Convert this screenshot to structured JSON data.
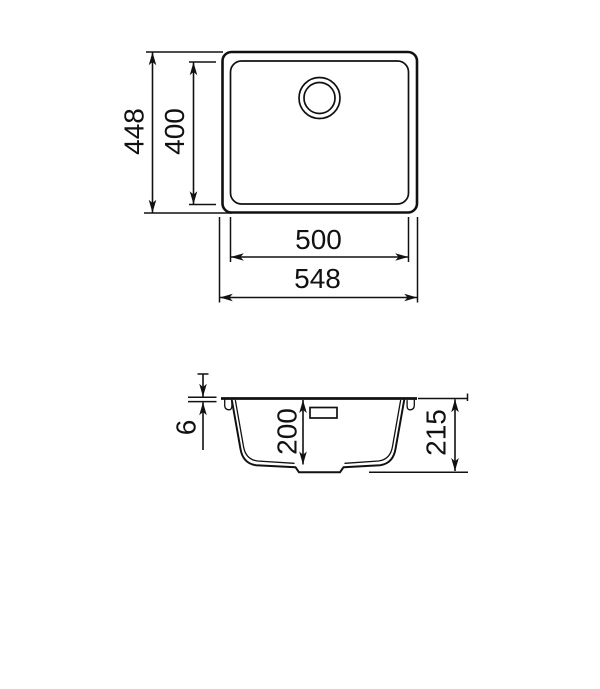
{
  "drawing": {
    "kind": "sink-dimension-drawing",
    "colors": {
      "line": "#111111",
      "background": "#ffffff"
    },
    "top_view": {
      "dim_outer_height": "448",
      "dim_inner_height": "400",
      "dim_inner_width": "500",
      "dim_outer_width": "548"
    },
    "section_view": {
      "dim_rim_thickness": "6",
      "dim_bowl_depth": "200",
      "dim_overall_depth": "215"
    }
  }
}
